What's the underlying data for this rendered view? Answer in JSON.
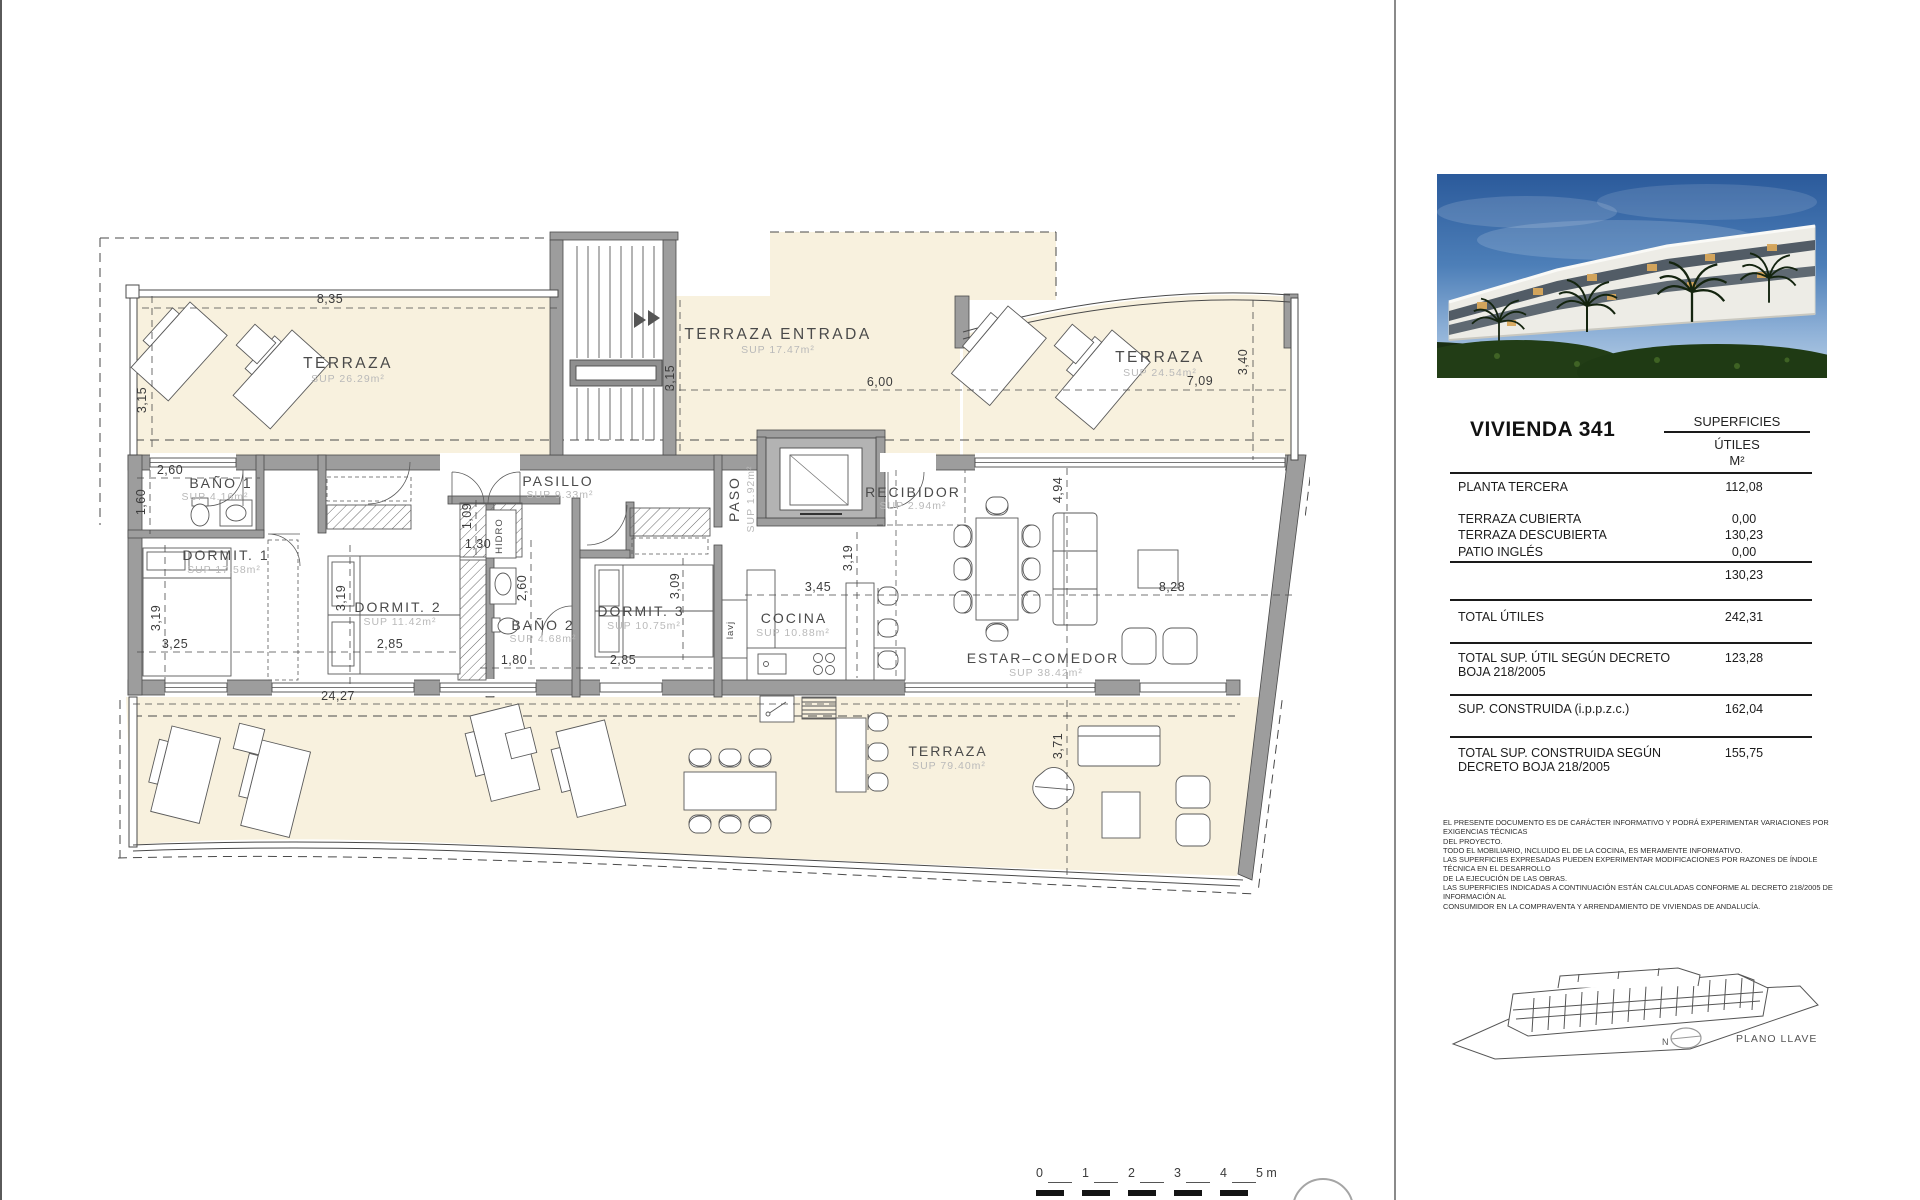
{
  "panel": {
    "title": "VIVIENDA 341",
    "table": {
      "header_line1": "SUPERFICIES",
      "header_line2": "ÚTILES",
      "header_line3": "M²",
      "rows": [
        {
          "label": "PLANTA TERCERA",
          "value": "112,08"
        },
        {
          "label": "TERRAZA CUBIERTA",
          "value": "0,00"
        },
        {
          "label": "TERRAZA DESCUBIERTA",
          "value": "130,23"
        },
        {
          "label": "PATIO INGLÉS",
          "value": "0,00"
        },
        {
          "label": "",
          "value": "130,23"
        },
        {
          "label": "TOTAL ÚTILES",
          "value": "242,31"
        },
        {
          "label": "TOTAL SUP. ÚTIL SEGÚN DECRETO BOJA 218/2005",
          "value": "123,28"
        },
        {
          "label": "SUP. CONSTRUIDA (i.p.p.z.c.)",
          "value": "162,04"
        },
        {
          "label": "TOTAL SUP. CONSTRUIDA SEGÚN DECRETO BOJA 218/2005",
          "value": "155,75"
        }
      ]
    },
    "disclaimer": [
      "EL PRESENTE DOCUMENTO ES DE CARÁCTER INFORMATIVO Y PODRÁ EXPERIMENTAR VARIACIONES POR EXIGENCIAS TÉCNICAS",
      "DEL PROYECTO.",
      "TODO EL MOBILIARIO, INCLUIDO EL DE LA COCINA, ES MERAMENTE INFORMATIVO.",
      "LAS SUPERFICIES EXPRESADAS PUEDEN EXPERIMENTAR MODIFICACIONES POR RAZONES DE ÍNDOLE TÉCNICA EN EL DESARROLLO",
      "DE LA EJECUCIÓN DE LAS OBRAS.",
      "LAS SUPERFICIES INDICADAS A CONTINUACIÓN ESTÁN CALCULADAS CONFORME AL DECRETO 218/2005 DE INFORMACIÓN AL",
      "CONSUMIDOR EN LA COMPRAVENTA Y ARRENDAMIENTO DE VIVIENDAS DE ANDALUCÍA."
    ],
    "keyplan_label": "PLANO LLAVE",
    "north_label": "N"
  },
  "plan": {
    "rooms": [
      {
        "name": "TERRAZA",
        "sup": "SUP 26.29m²"
      },
      {
        "name": "TERRAZA ENTRADA",
        "sup": "SUP 17.47m²"
      },
      {
        "name": "TERRAZA",
        "sup": "SUP 24.54m²"
      },
      {
        "name": "BAÑO 1",
        "sup": "SUP 4.16m²"
      },
      {
        "name": "DORMIT. 1",
        "sup": "SUP 17.58m²"
      },
      {
        "name": "DORMIT. 2",
        "sup": "SUP 11.42m²"
      },
      {
        "name": "PASILLO",
        "sup": "SUP 9.33m²"
      },
      {
        "name": "BAÑO 2",
        "sup": "SUP 4.68m²"
      },
      {
        "name": "DORMIT. 3",
        "sup": "SUP 10.75m²"
      },
      {
        "name": "PASO",
        "sup": "SUP 1.92m²"
      },
      {
        "name": "RECIBIDOR",
        "sup": "SUP 2.94m²"
      },
      {
        "name": "COCINA",
        "sup": "SUP 10.88m²"
      },
      {
        "name": "ESTAR–COMEDOR",
        "sup": "SUP 38.42m²"
      },
      {
        "name": "TERRAZA",
        "sup": "SUP 79.40m²"
      }
    ],
    "dims": [
      "8,35",
      "3,15",
      "2,60",
      "1,60",
      "3,19",
      "3,25",
      "3,19",
      "2,85",
      "1,09",
      "1,30",
      "3,15",
      "6,00",
      "2,60",
      "1,80",
      "3,09",
      "2,85",
      "3,19",
      "3,45",
      "3,40",
      "7,09",
      "4,94",
      "8,28",
      "24,27",
      "3,71"
    ],
    "annotations": {
      "shower": "HIDRO",
      "laundry": "lavj"
    },
    "scalebar": {
      "t0": "0",
      "t1": "1",
      "t2": "2",
      "t3": "3",
      "t4": "4",
      "t5": "5 m"
    }
  }
}
